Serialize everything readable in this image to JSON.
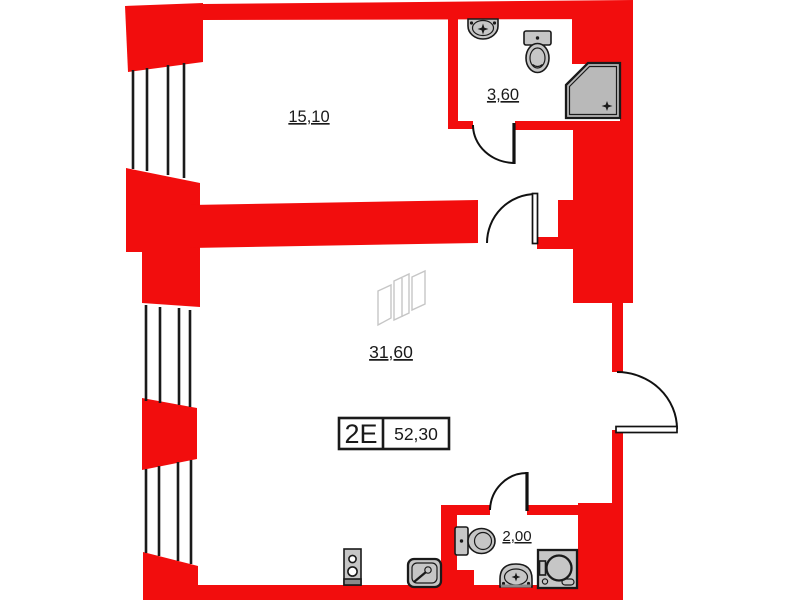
{
  "unit": {
    "label": "2E",
    "total_area": "52,30"
  },
  "rooms": [
    {
      "name": "room-upper",
      "area": "15,10"
    },
    {
      "name": "bathroom-upper",
      "area": "3,60"
    },
    {
      "name": "living-room",
      "area": "31,60"
    },
    {
      "name": "wc-lower",
      "area": "2,00"
    }
  ],
  "colors": {
    "wall_red": "#f20d0d",
    "fixture_fill": "#c6c6c6",
    "fixture_shower": "#b9b9b9",
    "fixture_dark": "#8a8a8a",
    "ink": "#1a1a1a",
    "ghost_gray": "#c6c6c6",
    "background": "#ffffff"
  },
  "icons": [
    "window-lines-icon",
    "door-arc-icon",
    "sink-icon",
    "toilet-icon",
    "shower-icon",
    "wc-toilet-icon",
    "wc-sink-icon",
    "washing-machine-icon",
    "stove-icon",
    "kitchen-sink-icon",
    "orientation-marker-icon"
  ]
}
